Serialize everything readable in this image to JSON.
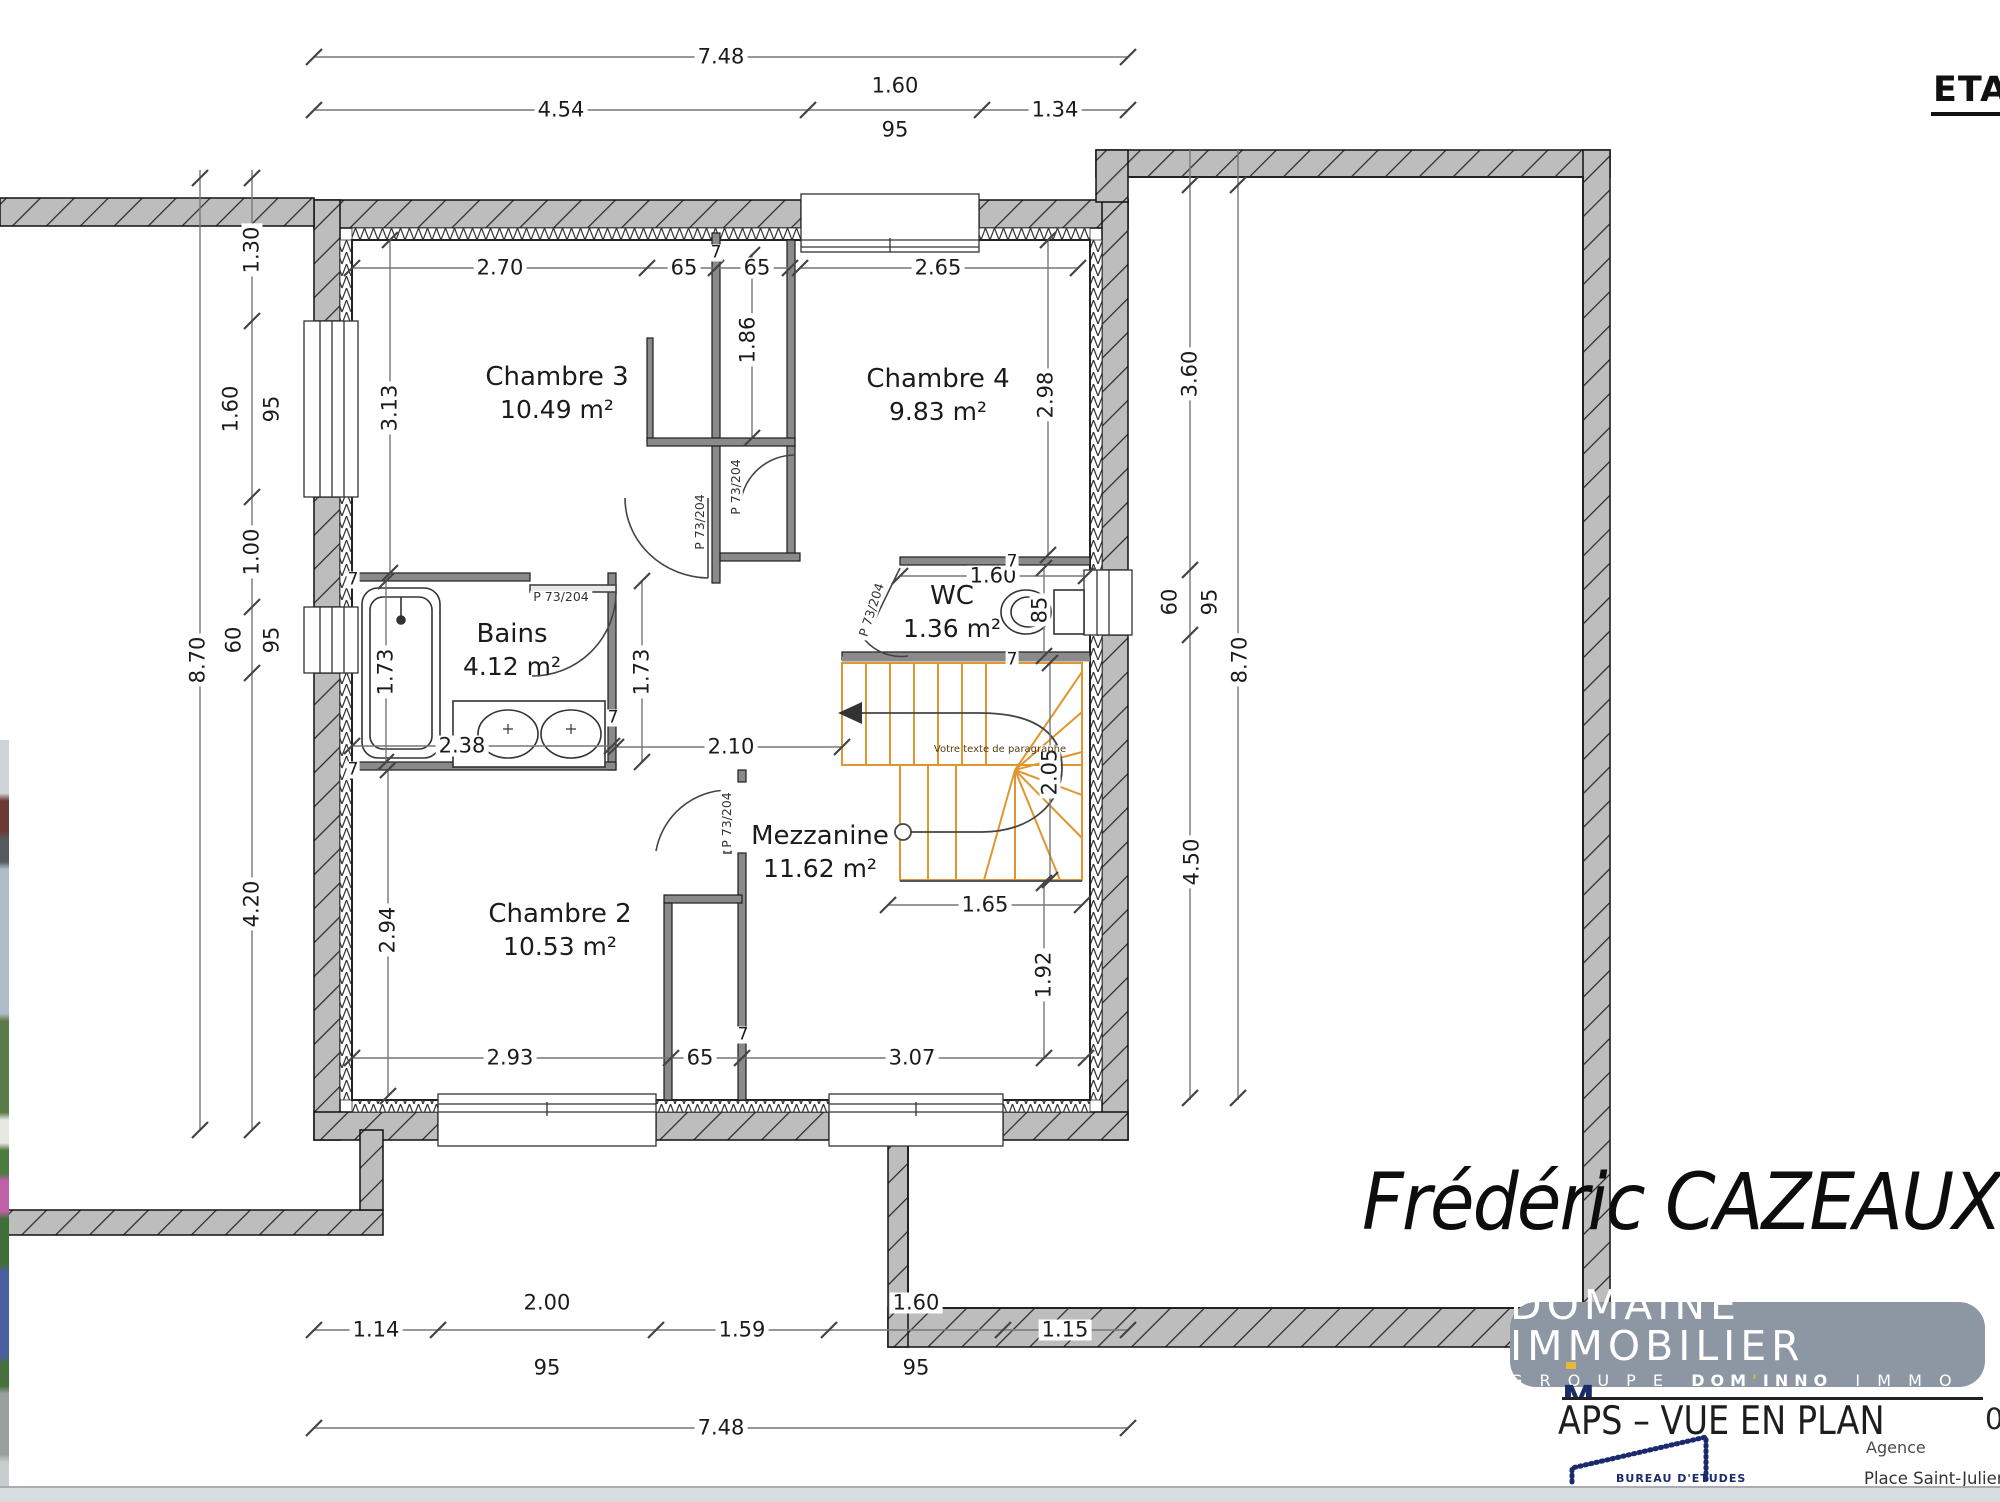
{
  "header": {
    "title": "ETAGE"
  },
  "plan": {
    "rooms": [
      {
        "name": "Chambre 3",
        "area": "10.49 m²",
        "x": 557,
        "y": 393
      },
      {
        "name": "Chambre 4",
        "area": "9.83 m²",
        "x": 938,
        "y": 395
      },
      {
        "name": "Bains",
        "area": "4.12 m²",
        "x": 512,
        "y": 650
      },
      {
        "name": "WC",
        "area": "1.36 m²",
        "x": 952,
        "y": 612
      },
      {
        "name": "Mezzanine",
        "area": "11.62 m²",
        "x": 820,
        "y": 852
      },
      {
        "name": "Chambre 2",
        "area": "10.53 m²",
        "x": 560,
        "y": 930
      }
    ],
    "dim_labels": [
      {
        "t": "7.48",
        "x": 721,
        "y": 57
      },
      {
        "t": "4.54",
        "x": 561,
        "y": 110
      },
      {
        "t": "1.60",
        "x": 895,
        "y": 86
      },
      {
        "t": "1.34",
        "x": 1055,
        "y": 110
      },
      {
        "t": "95",
        "x": 895,
        "y": 130
      },
      {
        "t": "1.30",
        "x": 252,
        "y": 250,
        "r": -90
      },
      {
        "t": "1.60",
        "x": 231,
        "y": 409,
        "r": -90
      },
      {
        "t": "95",
        "x": 272,
        "y": 409,
        "r": -90
      },
      {
        "t": "1.00",
        "x": 252,
        "y": 552,
        "r": -90
      },
      {
        "t": "60",
        "x": 234,
        "y": 640,
        "r": -90
      },
      {
        "t": "95",
        "x": 272,
        "y": 640,
        "r": -90
      },
      {
        "t": "4.20",
        "x": 252,
        "y": 904,
        "r": -90
      },
      {
        "t": "8.70",
        "x": 198,
        "y": 660,
        "r": -90
      },
      {
        "t": "3.60",
        "x": 1190,
        "y": 374,
        "r": -90
      },
      {
        "t": "60",
        "x": 1170,
        "y": 602,
        "r": -90
      },
      {
        "t": "95",
        "x": 1210,
        "y": 602,
        "r": -90
      },
      {
        "t": "4.50",
        "x": 1192,
        "y": 862,
        "r": -90
      },
      {
        "t": "8.70",
        "x": 1240,
        "y": 660,
        "r": -90
      },
      {
        "t": "1.14",
        "x": 376,
        "y": 1330
      },
      {
        "t": "2.00",
        "x": 547,
        "y": 1303
      },
      {
        "t": "95",
        "x": 547,
        "y": 1368
      },
      {
        "t": "1.59",
        "x": 742,
        "y": 1330
      },
      {
        "t": "1.60",
        "x": 916,
        "y": 1303
      },
      {
        "t": "95",
        "x": 916,
        "y": 1368
      },
      {
        "t": "1.15",
        "x": 1065,
        "y": 1330
      },
      {
        "t": "7.48",
        "x": 721,
        "y": 1428
      },
      {
        "t": "2.70",
        "x": 500,
        "y": 268
      },
      {
        "t": "65",
        "x": 684,
        "y": 268
      },
      {
        "t": "65",
        "x": 757,
        "y": 268
      },
      {
        "t": "1.86",
        "x": 748,
        "y": 340,
        "r": -90
      },
      {
        "t": "3.13",
        "x": 390,
        "y": 408,
        "r": -90
      },
      {
        "t": "2.65",
        "x": 938,
        "y": 268
      },
      {
        "t": "2.98",
        "x": 1046,
        "y": 395,
        "r": -90
      },
      {
        "t": "1.60",
        "x": 993,
        "y": 576
      },
      {
        "t": "85",
        "x": 1040,
        "y": 610,
        "r": -90
      },
      {
        "t": "2.10",
        "x": 731,
        "y": 747
      },
      {
        "t": "1.73",
        "x": 386,
        "y": 672,
        "r": -90
      },
      {
        "t": "1.73",
        "x": 642,
        "y": 672,
        "r": -90
      },
      {
        "t": "2.38",
        "x": 462,
        "y": 746
      },
      {
        "t": "2.05",
        "x": 1050,
        "y": 772,
        "r": -90
      },
      {
        "t": "1.65",
        "x": 985,
        "y": 905
      },
      {
        "t": "1.92",
        "x": 1044,
        "y": 975,
        "r": -90
      },
      {
        "t": "2.94",
        "x": 388,
        "y": 930,
        "r": -90
      },
      {
        "t": "2.93",
        "x": 510,
        "y": 1058
      },
      {
        "t": "65",
        "x": 700,
        "y": 1058
      },
      {
        "t": "3.07",
        "x": 912,
        "y": 1058
      }
    ],
    "wall_thickness_labels": [
      {
        "t": "7",
        "x": 716,
        "y": 253
      },
      {
        "t": "7",
        "x": 353,
        "y": 580
      },
      {
        "t": "7",
        "x": 353,
        "y": 770
      },
      {
        "t": "7",
        "x": 613,
        "y": 718
      },
      {
        "t": "7",
        "x": 1012,
        "y": 562
      },
      {
        "t": "7",
        "x": 1012,
        "y": 660
      },
      {
        "t": "7",
        "x": 743,
        "y": 1035
      }
    ],
    "door_labels": [
      {
        "t": "P 73/204",
        "x": 700,
        "y": 522,
        "r": -90
      },
      {
        "t": "P 73/204",
        "x": 736,
        "y": 487,
        "r": -90
      },
      {
        "t": "P 73/204",
        "x": 727,
        "y": 820,
        "r": -90
      },
      {
        "t": "P 73/204",
        "x": 561,
        "y": 597
      },
      {
        "t": "P 73/204",
        "x": 872,
        "y": 610,
        "r": -72
      }
    ],
    "stair_note": {
      "t": "Votre texte de paragraphe",
      "x": 1000,
      "y": 750
    }
  },
  "signature": {
    "name": "Frédéric CAZEAUX"
  },
  "branding": {
    "badge_line1": "DOMAINE IMMOBILIER",
    "badge_line2_prefix": "G R O U P E",
    "badge_line2_brand": "DOM'INNO",
    "badge_line2_suffix": "I M M O B I L I E R",
    "badge_bg": "#8d97a3",
    "accent_yellow": "#e6b83c",
    "navy": "#1b2a6b",
    "partial_name": "M. CAZEAUX",
    "doc_type": "APS – VUE EN PLAN",
    "phone_partial": "0",
    "agency_label": "Agence",
    "agency_address": "Place Saint-Julien 56 190",
    "bureau": "BUREAU D'ETUDES"
  },
  "colors": {
    "stair_orange": "#e0962f",
    "wall_hatch_gray": "#bdbdbd",
    "dim_line": "#666666"
  }
}
